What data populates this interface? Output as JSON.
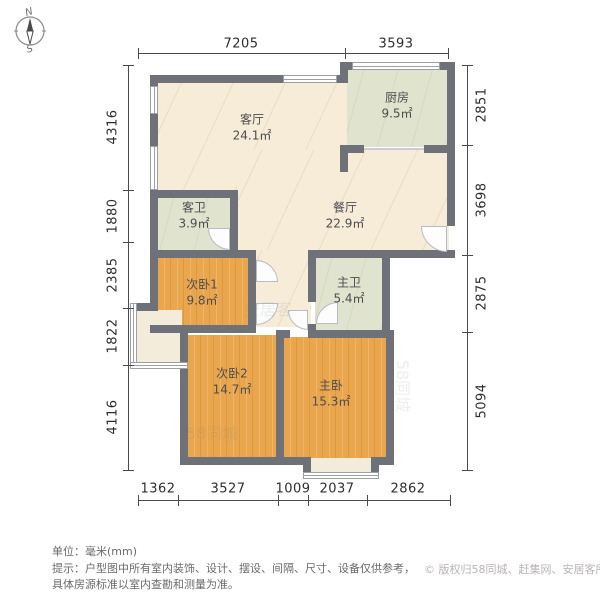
{
  "compass": {
    "north": "N",
    "south": "S"
  },
  "rooms": [
    {
      "id": "living",
      "name": "客厅",
      "area": "24.1㎡"
    },
    {
      "id": "kitchen",
      "name": "厨房",
      "area": "9.5㎡"
    },
    {
      "id": "dining",
      "name": "餐厅",
      "area": "22.9㎡"
    },
    {
      "id": "guest-bath",
      "name": "客卫",
      "area": "3.9㎡"
    },
    {
      "id": "bedroom1",
      "name": "次卧1",
      "area": "9.8㎡"
    },
    {
      "id": "master-bath",
      "name": "主卫",
      "area": "5.4㎡"
    },
    {
      "id": "bedroom2",
      "name": "次卧2",
      "area": "14.7㎡"
    },
    {
      "id": "master-bedroom",
      "name": "主卧",
      "area": "15.3㎡"
    }
  ],
  "dimensions": {
    "top": [
      "7205",
      "3593"
    ],
    "left": [
      "4316",
      "1880",
      "2385",
      "1822",
      "4116"
    ],
    "right": [
      "2851",
      "3698",
      "2875",
      "5094"
    ],
    "bottom": [
      "1362",
      "3527",
      "1009",
      "2037",
      "2862"
    ]
  },
  "watermarks": [
    "58同城",
    "安居客",
    "58同城"
  ],
  "footer": {
    "unit": "单位：毫米(mm)",
    "tip_line1": "提示：户型图中所有室内装饰、设计、摆设、间隔、尺寸、设备仅供参考，",
    "tip_line2": "具体房源标准以室内查勘和测量为准。",
    "copyright": "© 版权归58同城、赶集网、安居客所有"
  },
  "colors": {
    "wall": "#6e7177",
    "floor_cream": "#f6ecd8",
    "floor_wood": "#e9a64c",
    "floor_green": "#e0e3cd",
    "dim_text": "#2e2e2e",
    "copyright_text": "#bab3b3"
  }
}
